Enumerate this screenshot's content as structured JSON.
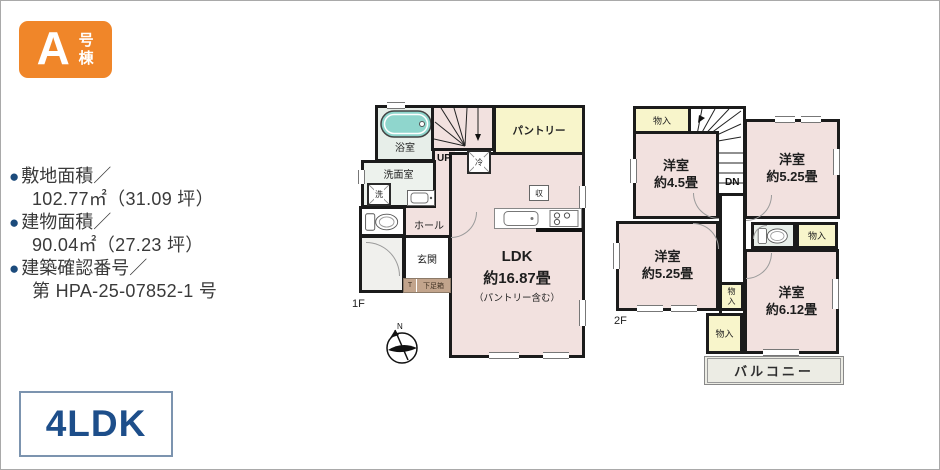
{
  "badge": {
    "letter": "A",
    "suffix": "号棟"
  },
  "specs": {
    "bullet": "●",
    "items": [
      {
        "label": "敷地面積／",
        "value": "102.77㎡（31.09 坪）"
      },
      {
        "label": "建物面積／",
        "value": "90.04㎡（27.23 坪）"
      },
      {
        "label": "建築確認番号／",
        "value": "第 HPA-25-07852-1 号"
      }
    ]
  },
  "layout_type": {
    "label": "4LDK"
  },
  "plan_1f": {
    "floor_label": "1F",
    "bath": "浴室",
    "washroom": "洗面室",
    "washer": "洗",
    "hall": "ホール",
    "entrance": "玄関",
    "shoe_t": "T",
    "shoe_box": "下足箱",
    "up": "UP",
    "fridge": "冷",
    "storage": "収",
    "pantry": "パントリー",
    "ldk_name": "LDK",
    "ldk_size": "約16.87畳",
    "ldk_note": "（パントリー含む）",
    "compass_n": "N"
  },
  "plan_2f": {
    "floor_label": "2F",
    "dn": "DN",
    "closet_top_left": "物入",
    "closet_right": "物入",
    "closet_mid_small": "物入",
    "closet_mid": "物入",
    "room_45": {
      "name": "洋室",
      "size": "約4.5畳"
    },
    "room_525_top": {
      "name": "洋室",
      "size": "約5.25畳"
    },
    "room_525_left": {
      "name": "洋室",
      "size": "約5.25畳"
    },
    "room_612": {
      "name": "洋室",
      "size": "約6.12畳"
    },
    "balcony": "バルコニー"
  },
  "colors": {
    "badge_orange": "#F08629",
    "bullet_navy": "#1C4B7C",
    "ldk_blue": "#1D4E8A",
    "ldk_box_border": "#7C94AF",
    "room_pink": "#F2E1DF",
    "closet_yellow": "#F8F5CB",
    "bath_green": "#E7EEE9",
    "tub_teal": "#8FD6CD",
    "balcony_gray": "#ECECE4",
    "shoe_brown": "#C2A48C",
    "wall_black": "#1B1B1B"
  },
  "icons": {
    "north-arrow-icon": "compass circle with north arrow (SVG)",
    "bathtub-icon": "rounded bathtub with drain (SVG)",
    "toilet-icon": "toilet tank and bowl (SVG)",
    "washer-icon": "square with X diagonals",
    "fridge-icon": "square with X diagonals",
    "vanity-sink-icon": "washstand basin (SVG)",
    "kitchen-counter-icon": "counter with sink and 3-burner stove (SVG)",
    "stairs-up-icon": "winder stair fan with arrow",
    "stairs-down-icon": "winder stair fan and treads"
  }
}
